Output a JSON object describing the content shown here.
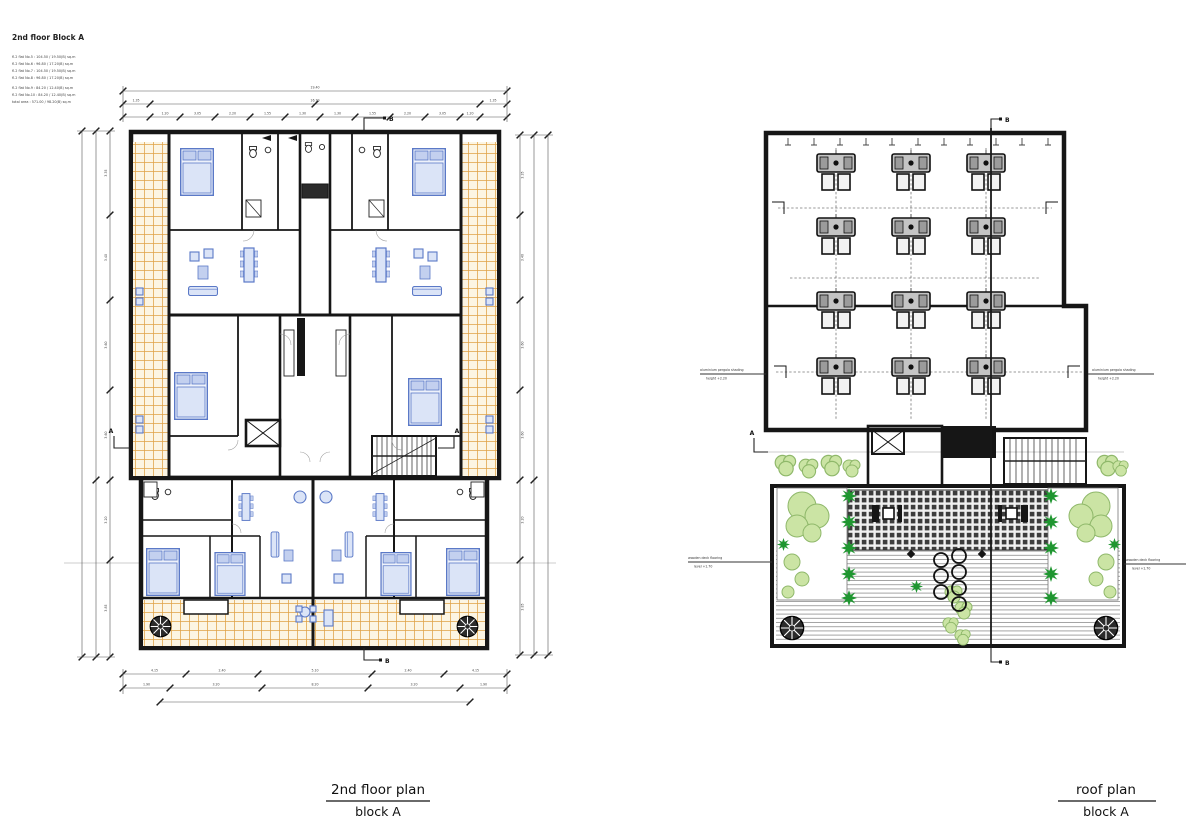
{
  "header": {
    "title": "2nd floor Block A",
    "schedule": [
      "fl.2 flat No.5 : 104.50 / 19.50(B) sq.m",
      "fl.2 flat No.6 :  96.80 / 17.20(B) sq.m",
      "fl.2 flat No.7 : 104.50 / 19.50(B) sq.m",
      "fl.2 flat No.8 :  96.80 / 17.20(B) sq.m",
      "fl.2 flat No.9 :  84.20 / 12.40(B) sq.m",
      "fl.2 flat No.10 : 84.20 / 12.40(B) sq.m",
      "total area : 571.00 / 98.20(B) sq.m"
    ]
  },
  "left_plan": {
    "caption_title": "2nd floor plan",
    "caption_sub": "block A",
    "section_labels": {
      "top": "B",
      "bottom": "B",
      "left": "A",
      "right": "A"
    },
    "dims": {
      "top_outer": "19.40",
      "top_mid": [
        "1.35",
        "16.70",
        "1.35"
      ],
      "top_inner": [
        "1.20",
        "3.05",
        "2.20",
        "1.55",
        "1.30",
        "1.30",
        "1.55",
        "2.20",
        "3.05",
        "1.20"
      ],
      "bottom_outer": [
        "4.15",
        "2.40",
        "5.10",
        "2.40",
        "4.15"
      ],
      "bottom_inner": [
        "1.90",
        "3.20",
        "8.20",
        "3.20",
        "1.90"
      ],
      "left_col": [
        "3.35",
        "3.40",
        "3.60",
        "3.60",
        "3.20",
        "3.85"
      ],
      "right_col": [
        "3.35",
        "3.40",
        "3.60",
        "3.60",
        "3.20",
        "3.85"
      ]
    }
  },
  "right_plan": {
    "caption_title": "roof plan",
    "caption_sub": "block A",
    "section_labels": {
      "top": "B",
      "bottom": "B",
      "left": "A"
    },
    "annotations": {
      "left_line1": "aluminium pergola shading",
      "left_line2": "height +2.20",
      "right_line1": "aluminium pergola shading",
      "right_line2": "height +2.20",
      "bottom_left_line1": "wooden deck flooring",
      "bottom_left_line2": "level +1.70",
      "bottom_right_line1": "wooden deck flooring",
      "bottom_right_line2": "level +1.70"
    }
  },
  "colors": {
    "wall": "#161616",
    "furniture_blue": "#5b79c7",
    "balcony_tile": "#dfa145",
    "tree_dark": "#1f9630",
    "bush_light": "#cbe4a4",
    "ac_gray": "#c4c4c4"
  }
}
